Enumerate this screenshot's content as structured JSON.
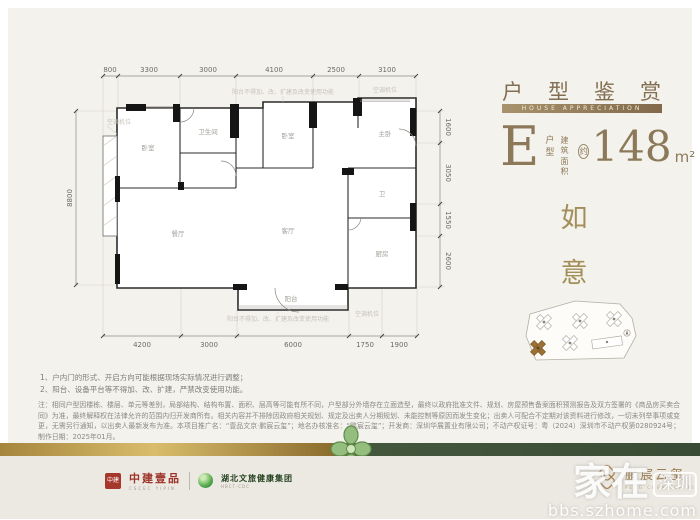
{
  "header": {
    "title": "户型鉴赏",
    "subtitle": "HOUSE APPRECIATION",
    "unit_letter": "E",
    "unit_word": [
      "户",
      "型"
    ],
    "area_word": [
      "建筑",
      "面积"
    ],
    "approx": "约",
    "area_value": "148",
    "area_unit": "m²"
  },
  "slogan": {
    "char1": "如",
    "char2": "意"
  },
  "floorplan": {
    "dims_top": [
      "800",
      "3300",
      "3000",
      "4100",
      "2500",
      "3100"
    ],
    "dims_bottom": [
      "4200",
      "3000",
      "6000",
      "1750",
      "1900"
    ],
    "dim_left": "8800",
    "dims_right": [
      "1600",
      "3050",
      "1550",
      "2600"
    ],
    "rooms": [
      "卧室",
      "卫生间",
      "卧室",
      "主卧",
      "餐厅",
      "客厅",
      "卫",
      "厨房",
      "阳台"
    ],
    "note_top": "阳台不得加、改、扩建及改变使用功能",
    "note_bottom": "阳台不得加、改、扩建及改变使用功能",
    "ac_label_left": "空调机位",
    "ac_label_right": "空调机位",
    "ac_label_bottom": "空调机位"
  },
  "notes": [
    "1、户内门的形式、开启方向可能根据现场实际情况进行调整；",
    "2、阳台、设备平台等不得加、改、扩建，严禁改变使用功能。"
  ],
  "disclaimer": "注：相同户型因楼栋、楼层、单元等差别，局部结构、结构布置、面积、层高等可能有所不同，户型部分外墙存在立面造型，最终以政府批准文件、规划、房屋预售备案面积预测报告及双方签署的《商品房买卖合同》为准，最终解释权在法律允许的范围内归开发商所有。相关内容并不排除因政府相关规划、规定及出卖人分期规划、未能控制等原因而发生变化；出卖人可配合不定期对该资料进行修改，一切未列举事项或变更，无需另行通知，以出卖人最新发布为准。本项目推广名：“壹品文京·鹏宸云玺”；地名办核准名：“鹏宸云玺”；开发商：深圳华展置业有限公司；不动产权证号：粤（2024）深圳市不动产权第0280924号；制作日期：2025年01月。",
  "footer": {
    "logo1_seal": "中建",
    "logo1_name": "中建壹品",
    "logo1_sub": "CSCEC YIPIN",
    "logo2_name": "湖北文旅健康集团",
    "logo2_sub": "HBCT·CDC",
    "brand_name": "鹏宸云玺",
    "brand_sub": "PENG CHEN YUN XI"
  },
  "watermark": {
    "main": "家在",
    "boxed": "深圳",
    "site": "bbs.szhome.com"
  }
}
